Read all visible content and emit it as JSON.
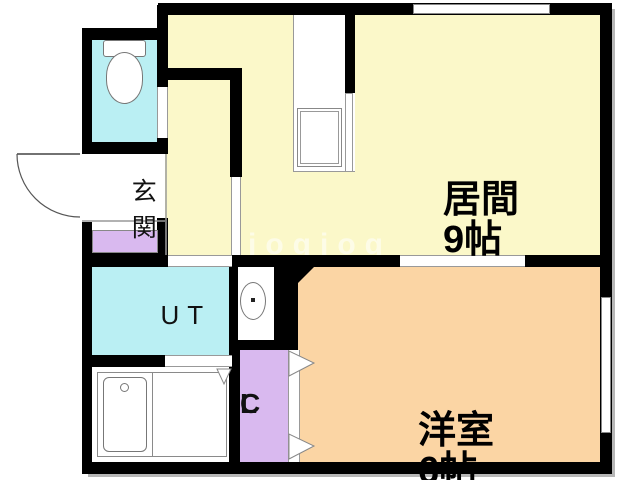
{
  "plan": {
    "type": "apartment-floor-plan",
    "watermark": "jogjog",
    "rooms": {
      "living": {
        "name": "居間",
        "size": "9帖"
      },
      "western": {
        "name": "洋室",
        "size": "6帖"
      },
      "entrance": {
        "name": "玄関"
      },
      "utility": {
        "name": "UT"
      },
      "closet": {
        "letter_top": "C",
        "letter_bottom": "L"
      }
    },
    "colors": {
      "wall": "#000000",
      "living_room": "#fbf8c9",
      "western_room": "#fbd5a4",
      "water_rooms": "#baeff3",
      "storage": "#d9b9ef",
      "background": "#ffffff"
    }
  }
}
